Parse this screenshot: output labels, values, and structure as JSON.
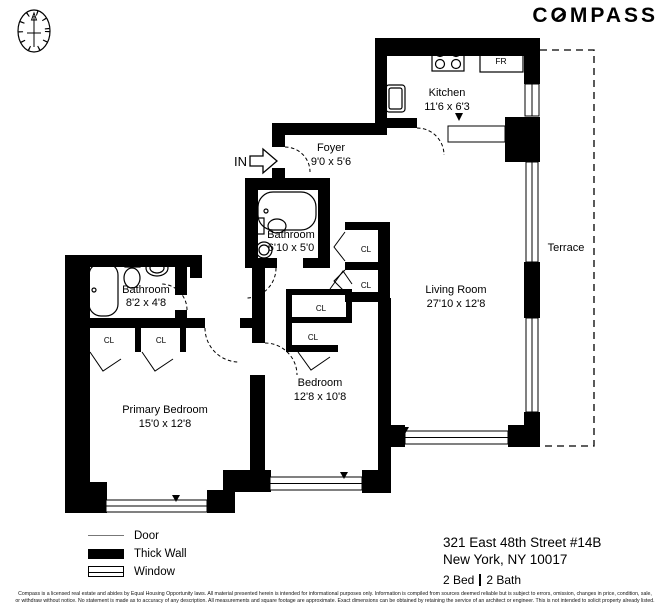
{
  "brand": {
    "c": "C",
    "o": "O",
    "rest": "MPASS"
  },
  "plan": {
    "in_label": "IN",
    "fr_label": "FR",
    "cl_label": "CL",
    "rooms": {
      "kitchen": {
        "name": "Kitchen",
        "dims": "11'6 x 6'3"
      },
      "foyer": {
        "name": "Foyer",
        "dims": "9'0 x 5'6"
      },
      "bathroom_small": {
        "name": "Bathroom",
        "dims": "6'10 x 5'0"
      },
      "bathroom_primary": {
        "name": "Bathroom",
        "dims": "8'2 x 4'8"
      },
      "living_room": {
        "name": "Living Room",
        "dims": "27'10 x 12'8"
      },
      "bedroom": {
        "name": "Bedroom",
        "dims": "12'8 x 10'8"
      },
      "primary_bedroom": {
        "name": "Primary Bedroom",
        "dims": "15'0 x 12'8"
      },
      "terrace": {
        "name": "Terrace"
      }
    }
  },
  "legend": {
    "door": "Door",
    "thick_wall": "Thick Wall",
    "window": "Window"
  },
  "address": {
    "line1": "321 East 48th Street #14B",
    "line2": "New York, NY 10017",
    "beds": "2 Bed",
    "baths": "2 Bath"
  },
  "disclaimer": {
    "line1": "Compass is a licensed real estate and abides by Equal Housing Opportunity laws. All material presented herein is intended for informational purposes only. Information is compiled from sources deemed reliable but is subject to errors, omission, changes in price, condition, sale,",
    "line2": "or withdraw without notice. No statement is made as to accuracy of any description. All measurements and square footage are approximate. Exact dimensions can be obtained by retaining the service of an architect or engineer. This is not intended to solicit property already listed."
  }
}
